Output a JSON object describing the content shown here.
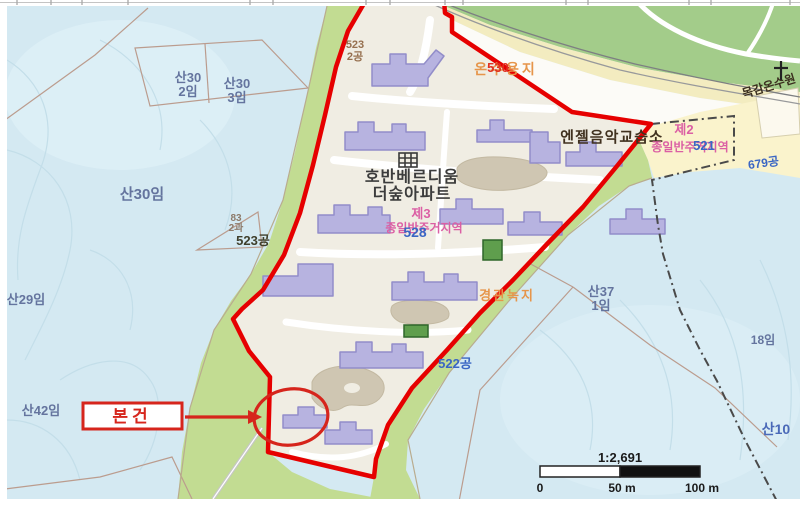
{
  "annotation": {
    "subject": "본건"
  },
  "scalebar": {
    "ratio": "1:2,691",
    "t0": "0",
    "t50": "50 m",
    "t100": "100 m"
  },
  "places": {
    "apt_line1": "호반베르디움",
    "apt_line2": "더숲아파트",
    "music_school": "엔젤음악교습소",
    "church": "목감온수원"
  },
  "zones": {
    "z2a": "제2",
    "z2b": "종일반주거지역",
    "z3a": "제3",
    "z3b": "종일반주거지역",
    "scenic_green": "경관녹지",
    "onsu_site": "온수용지"
  },
  "parcels": {
    "san30_2a": "산30",
    "san30_2b": "2임",
    "san30_3a": "산30",
    "san30_3b": "3임",
    "san30": "산30임",
    "san29": "산29임",
    "san42": "산42임",
    "san37a": "산37",
    "san37b": "1임",
    "p18": "18임",
    "san10": "산10",
    "p83a": "83",
    "p83b": "2과",
    "p523g": "523공",
    "p523ta": "523",
    "p523tb": "2공",
    "p522g": "522공",
    "p679g": "679공",
    "n521": "521",
    "n528": "528",
    "n530": "530"
  },
  "colors": {
    "boundary_red": "#e60000",
    "annotation_red": "#d6251c",
    "building_fill": "#b7b3e0",
    "zone_pink": "#db5fa4",
    "parcel_blue": "#3a66c4",
    "forest_blue": "#d4e9f2",
    "buffer_green": "#c2dc92",
    "park_green": "#a3cc8a"
  }
}
